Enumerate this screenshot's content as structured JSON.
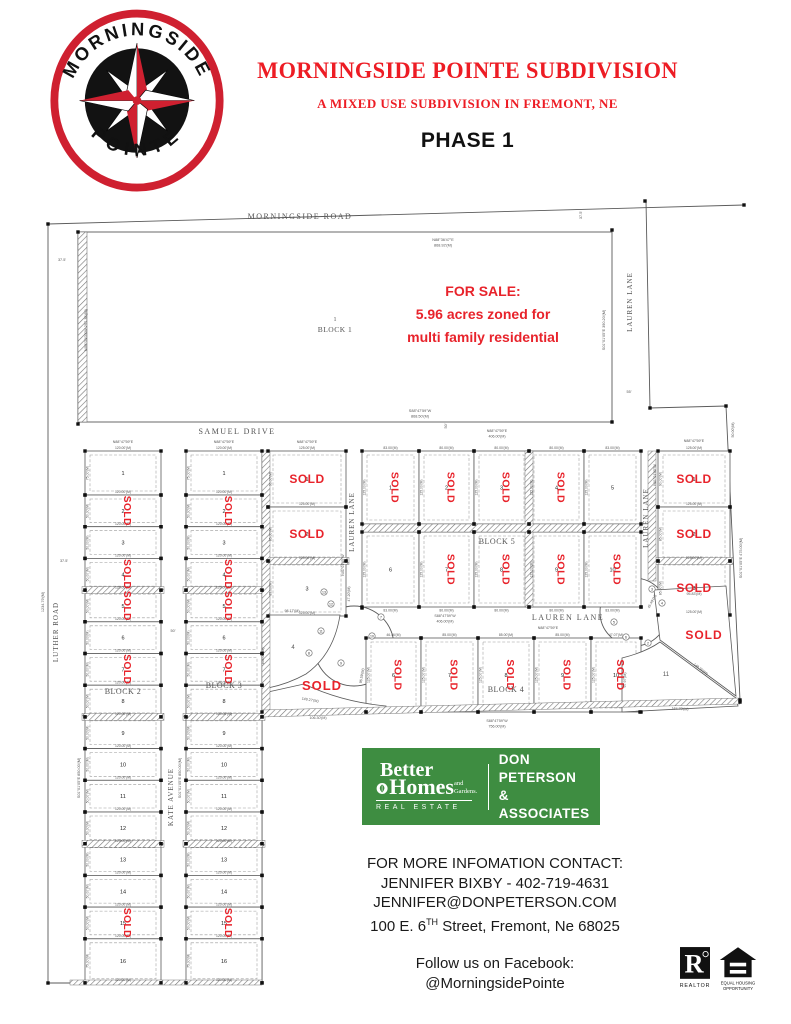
{
  "header": {
    "logo_arc_top": "MORNINGSIDE",
    "logo_arc_bottom": "POINTE",
    "title": "MORNINGSIDE POINTE SUBDIVISION",
    "subtitle": "A MIXED USE SUBDIVISION IN FREMONT, NE",
    "phase": "PHASE 1"
  },
  "colors": {
    "accent_red": "#ed1c24",
    "sold_red": "#e8232b",
    "brand_green": "#3e8d41",
    "map_line": "#5a5a5a",
    "map_text": "#555555"
  },
  "map": {
    "sold_text": "SOLD",
    "block1": {
      "number": "1",
      "name": "BLOCK 1"
    },
    "columns": [
      {
        "x": 85,
        "w": 76,
        "top": 451,
        "wdim": "120.00'(M)",
        "hdim": "50.00'(M)",
        "sold_rot": true,
        "hatch_after": [
          4,
          8,
          12
        ],
        "lots": [
          [
            "1",
            44,
            0,
            "75.00'(M)"
          ],
          [
            "2",
            31.7,
            1
          ],
          [
            "3",
            31.7,
            0
          ],
          [
            "4",
            31.7,
            1
          ],
          [
            "5",
            31.7,
            1
          ],
          [
            "6",
            31.7,
            0
          ],
          [
            "7",
            31.7,
            1
          ],
          [
            "8",
            31.7,
            0
          ],
          [
            "9",
            31.7,
            0
          ],
          [
            "10",
            31.7,
            0
          ],
          [
            "11",
            31.7,
            0
          ],
          [
            "12",
            31.7,
            0
          ],
          [
            "13",
            31.7,
            0
          ],
          [
            "14",
            31.7,
            0
          ],
          [
            "15",
            31.7,
            1
          ],
          [
            "16",
            44,
            0,
            "75.00'(M)"
          ]
        ]
      },
      {
        "x": 186,
        "w": 76,
        "top": 451,
        "wdim": "120.00'(M)",
        "hdim": "50.00'(M)",
        "sold_rot": true,
        "hatch_after": [
          4,
          8,
          12
        ],
        "lots": [
          [
            "1",
            44,
            0,
            "75.00'(M)"
          ],
          [
            "2",
            31.7,
            1
          ],
          [
            "3",
            31.7,
            0
          ],
          [
            "4",
            31.7,
            1
          ],
          [
            "5",
            31.7,
            1
          ],
          [
            "6",
            31.7,
            0
          ],
          [
            "7",
            31.7,
            1
          ],
          [
            "8",
            31.7,
            0
          ],
          [
            "9",
            31.7,
            0
          ],
          [
            "10",
            31.7,
            0
          ],
          [
            "11",
            31.7,
            0
          ],
          [
            "12",
            31.7,
            0
          ],
          [
            "13",
            31.7,
            0
          ],
          [
            "14",
            31.7,
            0
          ],
          [
            "15",
            31.7,
            1
          ],
          [
            "16",
            44,
            0,
            "75.00'(M)"
          ]
        ]
      },
      {
        "x": 268,
        "w": 78,
        "top": 451,
        "wdim": "125.00'(M)",
        "hdim": "90.00'(M)",
        "sold_rot": false,
        "hatch_after": [
          2
        ],
        "lots": [
          [
            "1",
            56,
            1
          ],
          [
            "2",
            54,
            1,
            "85.00'(M)"
          ],
          [
            "3",
            55,
            0,
            "85.00'(M)"
          ]
        ]
      },
      {
        "x": 658,
        "w": 72,
        "top": 451,
        "wdim": "125.00'(M)",
        "hdim": "90.00'(M)",
        "sold_rot": false,
        "hatch_after": [
          2
        ],
        "lots": [
          [
            "1",
            56,
            1
          ],
          [
            "2",
            54,
            1,
            "85.00'(M)"
          ],
          [
            "3",
            54,
            1,
            "85.00'(M)"
          ]
        ]
      }
    ],
    "block5": {
      "x": 362,
      "widths": [
        57,
        55,
        55,
        55,
        57
      ],
      "wdims": [
        "83.00'(M)",
        "80.00'(M)",
        "80.00'(M)",
        "80.00'(M)",
        "83.00'(M)"
      ],
      "hdim": "125.00'(M)",
      "sold_rot": true,
      "rows": [
        {
          "y": 451,
          "h": 73,
          "dimpos": "top",
          "lots": [
            [
              "1",
              1
            ],
            [
              "2",
              1
            ],
            [
              "3",
              1
            ],
            [
              "4",
              1
            ],
            [
              "5",
              0
            ]
          ]
        },
        {
          "y": 532,
          "h": 75,
          "dimpos": "bottom",
          "lots": [
            [
              "6",
              0
            ],
            [
              "7",
              1
            ],
            [
              "8",
              1
            ],
            [
              "9",
              1
            ],
            [
              "10",
              1
            ]
          ]
        }
      ]
    },
    "row4": {
      "x": 366,
      "y": 638,
      "h": 74,
      "widths": [
        55,
        57,
        56,
        57,
        50
      ],
      "wdims": [
        "46.46'(M)",
        "85.00'(M)",
        "85.00'(M)",
        "85.00'(M)",
        "47.07'(M)"
      ],
      "hdim": "125.00'(M)",
      "sold_rot": true,
      "lots": [
        [
          "6",
          1
        ],
        [
          "7",
          1
        ],
        [
          "8",
          1
        ],
        [
          "9",
          1
        ],
        [
          "10",
          1
        ]
      ]
    },
    "extra_sold": [
      {
        "x": 322,
        "y": 690,
        "fs": 13
      },
      {
        "x": 704,
        "y": 639,
        "fs": 12
      }
    ],
    "curves": [
      {
        "n": "13",
        "x": 324,
        "y": 592
      },
      {
        "n": "12",
        "x": 331,
        "y": 604
      },
      {
        "n": "11",
        "x": 321,
        "y": 631
      },
      {
        "n": "8",
        "x": 309,
        "y": 653
      },
      {
        "n": "9",
        "x": 341,
        "y": 663
      },
      {
        "n": "10",
        "x": 372,
        "y": 636
      },
      {
        "n": "7",
        "x": 381,
        "y": 617
      },
      {
        "n": "3",
        "x": 652,
        "y": 589
      },
      {
        "n": "4",
        "x": 662,
        "y": 603
      },
      {
        "n": "5",
        "x": 614,
        "y": 622
      },
      {
        "n": "6",
        "x": 626,
        "y": 637
      },
      {
        "n": "2",
        "x": 648,
        "y": 643
      }
    ],
    "annotations": [
      {
        "t": "MORNINGSIDE ROAD",
        "x": 300,
        "y": 219,
        "fs": 8,
        "ls": 1.5,
        "s": 1,
        "n": "street-label-morningside-road"
      },
      {
        "t": "N88°36'47\"E",
        "x": 443,
        "y": 241,
        "fs": 3.8
      },
      {
        "t": "868.92'(M)",
        "x": 443,
        "y": 246.5,
        "fs": 3.8
      },
      {
        "t": "37.5'",
        "x": 582,
        "y": 215,
        "fs": 3.8,
        "r": -90
      },
      {
        "t": "37.5'",
        "x": 62,
        "y": 261,
        "fs": 3.8
      },
      {
        "t": "N00°03'03\"W 297.36'(M)",
        "x": 87,
        "y": 330,
        "fs": 3.8,
        "r": -90
      },
      {
        "t": "S01°01'05\"E 390.20'(M)",
        "x": 605,
        "y": 330,
        "fs": 3.8,
        "r": -90
      },
      {
        "t": "LAUREN LANE",
        "x": 632,
        "y": 302,
        "fs": 7,
        "ls": 1,
        "s": 1,
        "r": -90,
        "n": "street-label-lauren-lane-north"
      },
      {
        "t": "55'",
        "x": 629,
        "y": 393,
        "fs": 3.8
      },
      {
        "t": "1",
        "x": 335,
        "y": 321,
        "fs": 6,
        "s": 1,
        "n": "block-1-number"
      },
      {
        "t": "BLOCK 1",
        "x": 335,
        "y": 332,
        "fs": 7.5,
        "s": 1,
        "ls": 0.5,
        "n": "block-1-label"
      },
      {
        "t": "FOR SALE:",
        "x": 483,
        "y": 296,
        "fs": 14,
        "b": 1,
        "c": "#e8232b",
        "n": "for-sale-line-1"
      },
      {
        "t": "5.96 acres zoned for",
        "x": 483,
        "y": 319,
        "fs": 14,
        "b": 1,
        "c": "#e8232b",
        "n": "for-sale-line-2"
      },
      {
        "t": "multi family residential",
        "x": 483,
        "y": 342,
        "fs": 14,
        "b": 1,
        "c": "#e8232b",
        "n": "for-sale-line-3"
      },
      {
        "t": "S88°47'59\"W",
        "x": 420,
        "y": 412,
        "fs": 3.8
      },
      {
        "t": "868.50'(M)",
        "x": 420,
        "y": 417.5,
        "fs": 3.8
      },
      {
        "t": "SAMUEL DRIVE",
        "x": 237,
        "y": 434,
        "fs": 8,
        "ls": 1.5,
        "s": 1,
        "n": "street-label-samuel-drive"
      },
      {
        "t": "N88°47'59\"E",
        "x": 123,
        "y": 443,
        "fs": 3.6
      },
      {
        "t": "N88°47'59\"E",
        "x": 224,
        "y": 443,
        "fs": 3.6
      },
      {
        "t": "N88°47'59\"E",
        "x": 307,
        "y": 443,
        "fs": 3.6
      },
      {
        "t": "N88°47'59\"E",
        "x": 694,
        "y": 442,
        "fs": 3.6
      },
      {
        "t": "N88°47'59\"E",
        "x": 497,
        "y": 432,
        "fs": 3.6
      },
      {
        "t": "406.00'(M)",
        "x": 497,
        "y": 437.5,
        "fs": 3.6
      },
      {
        "t": "50'",
        "x": 447,
        "y": 426,
        "fs": 3.8,
        "r": -90
      },
      {
        "t": "37.5'",
        "x": 64,
        "y": 562,
        "fs": 3.8
      },
      {
        "t": "LUTHER ROAD",
        "x": 58,
        "y": 632,
        "fs": 7,
        "s": 1,
        "r": -90,
        "ls": 1,
        "n": "street-label-luther-road"
      },
      {
        "t": "1234.79'(M)",
        "x": 44,
        "y": 602,
        "fs": 3.8,
        "r": -90
      },
      {
        "t": "S01°01'05\"E 850.00'(M)",
        "x": 80,
        "y": 778,
        "fs": 3.8,
        "r": -90
      },
      {
        "t": "S01°01'05\"E 850.00'(M)",
        "x": 181,
        "y": 778,
        "fs": 3.8,
        "r": -90
      },
      {
        "t": "KATE AVENUE",
        "x": 173,
        "y": 797,
        "fs": 7,
        "s": 1,
        "r": -90,
        "ls": 1,
        "n": "street-label-kate-avenue"
      },
      {
        "t": "50'",
        "x": 173,
        "y": 632,
        "fs": 3.8
      },
      {
        "t": "LAUREN LANE",
        "x": 354,
        "y": 522,
        "fs": 7,
        "s": 1,
        "r": -90,
        "ls": 1,
        "n": "street-label-lauren-lane-west"
      },
      {
        "t": "N01°01'05\"W",
        "x": 344,
        "y": 565,
        "fs": 3.6,
        "r": -90
      },
      {
        "t": "BLOCK 2",
        "x": 123,
        "y": 694,
        "fs": 8,
        "s": 1,
        "ls": 0.5,
        "n": "block-2-label"
      },
      {
        "t": "BLOCK 3",
        "x": 224,
        "y": 688,
        "fs": 8,
        "s": 1,
        "ls": 0.5,
        "n": "block-3-label"
      },
      {
        "t": "BLOCK 5",
        "x": 497,
        "y": 544,
        "fs": 8,
        "s": 1,
        "ls": 0.5,
        "n": "block-5-label"
      },
      {
        "t": "S88°47'59\"W",
        "x": 445,
        "y": 617,
        "fs": 3.6
      },
      {
        "t": "406.00'(M)",
        "x": 445,
        "y": 622.5,
        "fs": 3.6
      },
      {
        "t": "LAUREN LANE",
        "x": 568,
        "y": 620,
        "fs": 8,
        "ls": 1.5,
        "s": 1,
        "n": "street-label-lauren-lane-mid"
      },
      {
        "t": "N88°47'59\"E",
        "x": 548,
        "y": 629,
        "fs": 3.6
      },
      {
        "t": "BLOCK 4",
        "x": 506,
        "y": 692,
        "fs": 8,
        "s": 1,
        "ls": 0.5,
        "n": "block-4-label"
      },
      {
        "t": "S88°47'59\"W",
        "x": 497,
        "y": 722,
        "fs": 3.6
      },
      {
        "t": "756.00'(M)",
        "x": 497,
        "y": 727.5,
        "fs": 3.6
      },
      {
        "t": "LAUREN LANE",
        "x": 648,
        "y": 518,
        "fs": 7,
        "s": 1,
        "r": -90,
        "ls": 1,
        "n": "street-label-lauren-lane-east"
      },
      {
        "t": "N01°01'05\"W",
        "x": 656,
        "y": 475,
        "fs": 3.6,
        "r": -90
      },
      {
        "t": "S01°01'05\"E 475.00'(M)",
        "x": 742,
        "y": 558,
        "fs": 3.8,
        "r": -90
      },
      {
        "t": "50.00'(M)",
        "x": 734,
        "y": 430,
        "fs": 3.6,
        "r": -90
      },
      {
        "t": "4",
        "x": 293,
        "y": 649,
        "fs": 6,
        "n": "lot-number"
      },
      {
        "t": "98.17'(M)",
        "x": 292,
        "y": 612,
        "fs": 3.6
      },
      {
        "t": "165.00'(M)",
        "x": 264,
        "y": 656,
        "fs": 3.6,
        "r": -90
      },
      {
        "t": "149.27'(M)",
        "x": 310,
        "y": 701,
        "fs": 3.6,
        "r": 10
      },
      {
        "t": "106.30'(M)",
        "x": 318,
        "y": 719,
        "fs": 3.6
      },
      {
        "t": "96.59'(M)",
        "x": 363,
        "y": 676,
        "fs": 3.6,
        "r": -80
      },
      {
        "t": "11",
        "x": 666,
        "y": 676,
        "fs": 6,
        "n": "lot-number"
      },
      {
        "t": "97.97'(M)",
        "x": 626,
        "y": 680,
        "fs": 3.6,
        "r": -90
      },
      {
        "t": "164.70'(M)",
        "x": 680,
        "y": 710,
        "fs": 3.6,
        "r": 3
      },
      {
        "t": "95.83'(M)",
        "x": 694,
        "y": 595,
        "fs": 3.6
      },
      {
        "t": "148.35'(M)",
        "x": 700,
        "y": 670,
        "fs": 3.6,
        "r": 38
      },
      {
        "t": "45.49'(M)",
        "x": 653,
        "y": 602,
        "fs": 3.6,
        "r": -62
      },
      {
        "t": "47.20'(M)",
        "x": 350,
        "y": 594,
        "fs": 3.6,
        "r": -90
      }
    ]
  },
  "brand": {
    "better": "Better",
    "homes": "Homes",
    "and_gardens": "and Gardens.",
    "real_estate": "REAL ESTATE",
    "right_line1": "DON PETERSON",
    "right_line2": "& ASSOCIATES"
  },
  "contact": {
    "heading": "FOR MORE INFOMATION CONTACT:",
    "line1": "JENNIFER BIXBY - 402-719-4631",
    "line2": "JENNIFER@DONPETERSON.COM",
    "addr_pre": "100 E. 6",
    "addr_sup": "TH",
    "addr_post": " Street, Fremont, Ne 68025",
    "fb1": "Follow us on Facebook:",
    "fb2": "@MorningsidePointe"
  },
  "footer_icons": {
    "realtor_letter": "R",
    "realtor_caption": "REALTOR",
    "equal_caption1": "EQUAL HOUSING",
    "equal_caption2": "OPPORTUNITY"
  }
}
